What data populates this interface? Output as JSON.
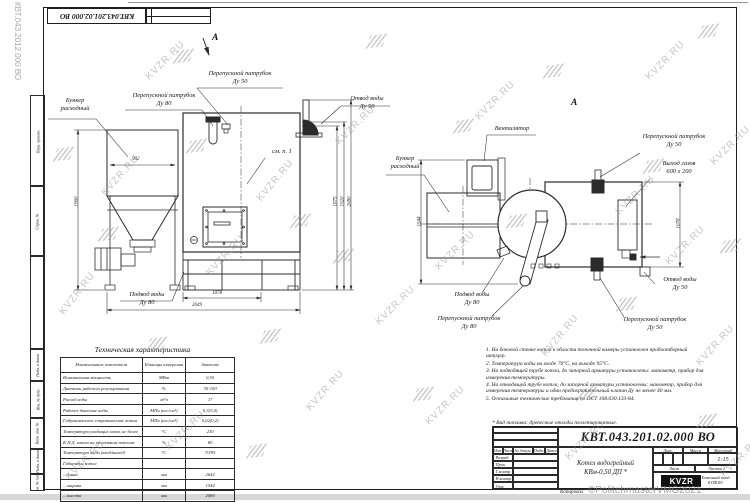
{
  "watermark": {
    "text": "KVZR.RU",
    "side_text": "КВТ.043.2012.000 ВО",
    "copyright": "©PolitehmasterVMG2021"
  },
  "stamp": {
    "doc_number": "КВТ.043.201.02.000 ВО"
  },
  "frame": {
    "left_labels": [
      "Перв. примен.",
      "Справ. №",
      "Подп. и дата",
      "Инв. № дубл.",
      "Взам. инв. №",
      "Подп. и дата",
      "Инв. № подл."
    ],
    "kopiroval": "Копировал"
  },
  "views": {
    "left": {
      "section_mark": "А",
      "labels": {
        "bunker": "Бункер\nрасходный",
        "overflow80": "Перепускной патрубок\nДу 80",
        "overflow50": "Перепускной патрубок\nДу 50",
        "outlet": "Отвод воды\nДу 50",
        "see_note": "см. п. 1",
        "inlet": "Подвод воды\nДу 80"
      },
      "dims": {
        "bunker_width": "902",
        "bunker_height": "1960",
        "h1": "1875",
        "h2": "1920",
        "h3": "2080",
        "len1": "1078",
        "len2": "2649"
      }
    },
    "right": {
      "section_mark": "А",
      "labels": {
        "fan": "Вентилятор",
        "bunker": "Бункер\nрасходный",
        "overflow50_top": "Перепускной патрубок\nДу 50",
        "gas_outlet": "Выход газов\n600 х 200",
        "outlet": "Отвод воды\nДу 50",
        "inlet": "Подвод воды\nДу 80",
        "overflow80": "Перепускной патрубок\nДу 80",
        "overflow50_bottom": "Перепускной патрубок\nДу 50"
      },
      "dims": {
        "w1": "1544",
        "w2": "1078"
      }
    }
  },
  "spec_table": {
    "title": "Техническая характеристика",
    "headers": [
      "Наименование показателя",
      "Единицы измерения",
      "Значение"
    ],
    "rows": [
      [
        "Номинальная мощность",
        "МВт",
        "0,50"
      ],
      [
        "Диапазон рабочего регулирования",
        "%",
        "30-100"
      ],
      [
        "Расход воды",
        "м³/ч",
        "17"
      ],
      [
        "Рабочее давление воды",
        "МПа (кгс/см²)",
        "0,3(3,0)"
      ],
      [
        "Гидравлическое сопротивление котла",
        "МПа (кгс/см²)",
        "0,02(0,2)"
      ],
      [
        "Температура уходящих газов, не более",
        "°С",
        "230"
      ],
      [
        "К.П.Д. котла на проектном топливе",
        "%",
        "80"
      ],
      [
        "Температура воды (вход/выход)",
        "°С",
        "70/95"
      ],
      [
        "Габариты котла",
        "",
        ""
      ],
      [
        "– длина",
        "мм",
        "2642"
      ],
      [
        "– ширина",
        "мм",
        "1544"
      ],
      [
        "– высота",
        "мм",
        "2080"
      ]
    ]
  },
  "notes": {
    "items": [
      "1. На боковой стенке котла в области топочной камеры установлен пробоотборный штуцер.",
      "2. Температура воды на входе 70°С, на выходе 95°С.",
      "3. На подводящей трубе котла, до запорной арматуры установлены: манометр, прибор для измерения температуры.",
      "4. На отводящей трубе котла, до запорной арматуры установлены: манометр, прибор для измерения температуры и один предохранительный клапан Ду не менее 40 мм.",
      "5. Остальные технические требования по ОСТ 108.030.133-84."
    ],
    "fuel": "* Вид топлива: древесные отходы пеллетированные."
  },
  "title_block": {
    "doc_number": "КВТ.043.201.02.000 ВО",
    "product_line1": "Котел водогрейный",
    "product_line2": "КВм-0,50 ДП *",
    "cols": {
      "izm": "Изм.",
      "list": "Лист",
      "doc": "№ докум.",
      "sign": "Подп.",
      "date": "Дата"
    },
    "rows": [
      "Разраб.",
      "Пров.",
      "Т.контр.",
      "Н.контр.",
      "Утв."
    ],
    "props": {
      "lit": "Лит.",
      "mass": "Масса",
      "scale": "Масштаб",
      "scale_value": "1:15",
      "sheet": "Лист",
      "sheets": "Листов 1"
    },
    "brand": {
      "logo": "KVZR",
      "company": "Котельный завод",
      "site": "KVZR.RU"
    }
  }
}
